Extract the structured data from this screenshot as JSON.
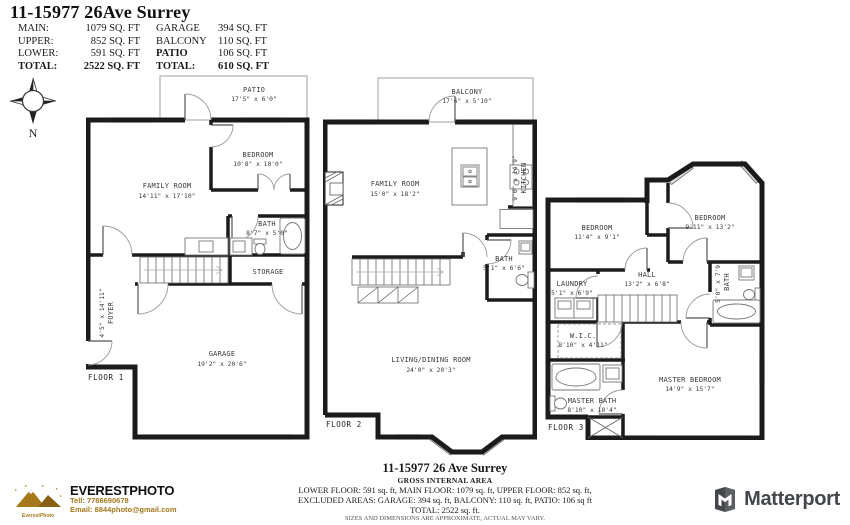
{
  "header": {
    "title": "11-15977 26Ave Surrey",
    "rows": [
      {
        "l1": "MAIN:",
        "v1": "1079 SQ. FT",
        "l2": "GARAGE",
        "v2": "394 SQ. FT"
      },
      {
        "l1": "UPPER:",
        "v1": "852 SQ. FT",
        "l2": "BALCONY",
        "v2": "110 SQ. FT"
      },
      {
        "l1": "LOWER:",
        "v1": "591 SQ. FT",
        "l2": "PATIO",
        "v2": "106 SQ. FT"
      },
      {
        "l1": "TOTAL:",
        "v1": "2522 SQ. FT",
        "l2": "TOTAL:",
        "v2": "610 SQ. FT"
      }
    ]
  },
  "compass": {
    "north_label": "N"
  },
  "floor1": {
    "floor_label": "FLOOR 1",
    "rooms": {
      "patio": {
        "name": "PATIO",
        "dims": "17'5\" x 6'0\""
      },
      "family": {
        "name": "FAMILY ROOM",
        "dims": "14'11\" x 17'10\""
      },
      "bedroom": {
        "name": "BEDROOM",
        "dims": "10'8\" x 10'0\""
      },
      "bath": {
        "name": "BATH",
        "dims": "8'7\" x 5'0\""
      },
      "storage": {
        "name": "STORAGE"
      },
      "foyer": {
        "name": "FOYER",
        "dims": "4'5\" x 14'11\""
      },
      "garage": {
        "name": "GARAGE",
        "dims": "19'2\" x 20'6\""
      }
    }
  },
  "floor2": {
    "floor_label": "FLOOR 2",
    "rooms": {
      "balcony": {
        "name": "BALCONY",
        "dims": "17'6\" x 5'10\""
      },
      "family": {
        "name": "FAMILY ROOM",
        "dims": "15'0\" x 18'2\""
      },
      "kitchen": {
        "name": "KITCHEN",
        "dims": "9'0\" x 14'9\""
      },
      "bath": {
        "name": "BATH",
        "dims": "5'1\" x 6'6\""
      },
      "living": {
        "name": "LIVING/DINING ROOM",
        "dims": "24'0\" x 20'3\""
      }
    }
  },
  "floor3": {
    "floor_label": "FLOOR 3",
    "rooms": {
      "bedroom1": {
        "name": "BEDROOM",
        "dims": "11'4\" x 9'1\""
      },
      "bedroom2": {
        "name": "BEDROOM",
        "dims": "9'11\" x 13'2\""
      },
      "hall": {
        "name": "HALL",
        "dims": "13'2\" x 6'8\""
      },
      "laundry": {
        "name": "LAUNDRY",
        "dims": "5'1\" x 6'9\""
      },
      "bath": {
        "name": "BATH",
        "dims": "5'0\" x 7'9\""
      },
      "wic": {
        "name": "W.I.C.",
        "dims": "8'10\" x 4'11\""
      },
      "master_bath": {
        "name": "MASTER BATH",
        "dims": "8'10\" x 10'4\""
      },
      "master_bedroom": {
        "name": "MASTER BEDROOM",
        "dims": "14'9\" x 15'7\""
      }
    }
  },
  "footer": {
    "address": "11-15977 26 Ave Surrey",
    "subtitle": "GROSS INTERNAL AREA",
    "line1": "LOWER FLOOR: 591 sq. ft,  MAIN FLOOR: 1079 sq. ft, UPPER FLOOR: 852 sq. ft,",
    "line2": "EXCLUDED AREAS: GARAGE: 394 sq. ft, BALCONY: 110 sq. ft, PATIO: 106 sq ft",
    "line3": "TOTAL: 2522 sq. ft.",
    "disclaimer": "SIZES AND DIMENSIONS ARE APPROXIMATE, ACTUAL MAY VARY."
  },
  "vendor": {
    "name": "EVERESTPHOTO",
    "logo_text": "EverestPhoto",
    "phone": "Tell: 7786690678",
    "email": "Email: 8844photo@gmail.com",
    "brand_color": "#a5781c"
  },
  "matterport": {
    "name": "Matterport"
  }
}
